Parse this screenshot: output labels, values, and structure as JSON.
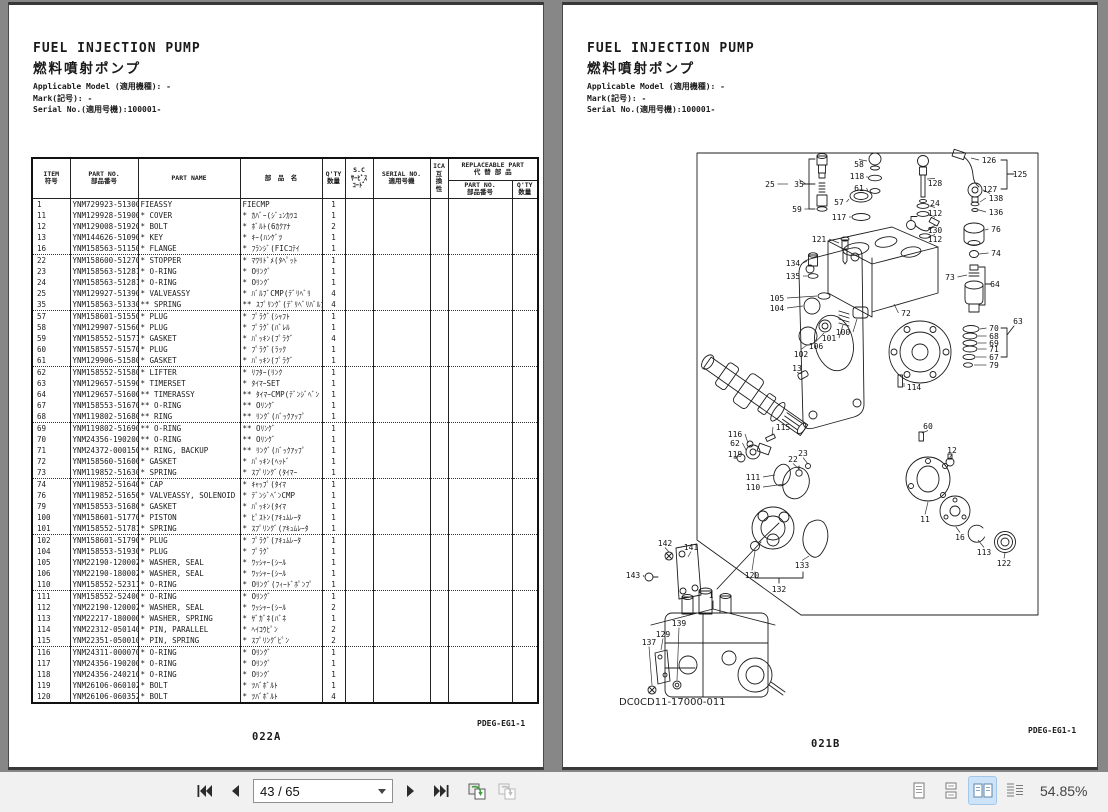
{
  "left_page": {
    "title_en": "FUEL INJECTION PUMP",
    "title_jp": "燃料噴射ポンプ",
    "meta_lines": [
      "Applicable Model (適用機種): -",
      "Mark(記号): -",
      "Serial No.(適用号機):100001-"
    ],
    "table": {
      "headers": {
        "item": "ITEM\n符号",
        "part_no": "PART NO.\n部品番号",
        "part_name": "PART NAME",
        "part_name_jp": "部　品　名",
        "qty": "Q'TY\n数量",
        "sc": "S.C\nｻｰﾋﾞｽ\nｺｰﾄﾞ",
        "serial_no": "SERIAL NO.\n適用号機",
        "ica": "ICA\n互\n換\n性",
        "replaceable": "REPLACEABLE PART\n代 替 部 品",
        "r_part_no": "PART NO.\n部品番号",
        "r_qty": "Q'TY\n数量"
      },
      "rows": [
        [
          "1",
          "YNM729923-51300",
          "FIEASSY",
          "FIECMP",
          "1"
        ],
        [
          "11",
          "YNM129928-51900",
          "* COVER",
          "* ｶﾊﾞｰ(ｼﾞｭﾝｶﾂﾕ",
          "1"
        ],
        [
          "12",
          "YNM129008-51920",
          "* BOLT",
          "* ﾎﾞﾙﾄ(6ｶｸｱﾅ",
          "2"
        ],
        [
          "13",
          "YNM144626-51090",
          "* KEY",
          "* ｷｰ(ﾊﾝｹﾞﾂ",
          "1"
        ],
        [
          "16",
          "YNM158563-51150",
          "* FLANGE",
          "* ﾌﾗﾝｼﾞ(FICｺﾃｲ",
          "1"
        ],
        [
          "22",
          "YNM158600-51270",
          "* STOPPER",
          "* ﾏﾜﾘﾄﾞﾒ(ﾀﾍﾟｯﾄ",
          "1"
        ],
        [
          "23",
          "YNM158563-51281",
          "* O-RING",
          "* Oﾘﾝｸﾞ",
          "1"
        ],
        [
          "24",
          "YNM158563-51281",
          "* O-RING",
          "* Oﾘﾝｸﾞ",
          "1"
        ],
        [
          "25",
          "YNM129927-51390",
          "* VALVEASSY",
          "* ﾊﾞﾙﾌﾞCMP(ﾃﾞﾘﾍﾞﾘ",
          "4"
        ],
        [
          "35",
          "YNM158563-51330",
          "** SPRING",
          "** ｽﾌﾟﾘﾝｸﾞ(ﾃﾞﾘﾍﾞﾘﾊﾞﾙﾌﾞ",
          "4"
        ],
        [
          "57",
          "YNM158601-51550",
          "* PLUG",
          "* ﾌﾟﾗｸﾞ(ｼｬﾌﾄ",
          "1"
        ],
        [
          "58",
          "YNM129907-51560",
          "* PLUG",
          "* ﾌﾟﾗｸﾞ(ﾊﾞﾚﾙ",
          "1"
        ],
        [
          "59",
          "YNM158552-51571",
          "* GASKET",
          "* ﾊﾟｯｷﾝ(ﾌﾟﾗｸﾞ",
          "4"
        ],
        [
          "60",
          "YNM158557-51570",
          "* PLUG",
          "* ﾌﾟﾗｸﾞ(ﾗｯｸ",
          "1"
        ],
        [
          "61",
          "YNM129906-51580",
          "* GASKET",
          "* ﾊﾟｯｷﾝ(ﾌﾟﾗｸﾞ",
          "1"
        ],
        [
          "62",
          "YNM158552-51580",
          "* LIFTER",
          "* ﾘﾌﾀｰ(ﾘﾝｸ",
          "1"
        ],
        [
          "63",
          "YNM129657-51590",
          "* TIMERSET",
          "* ﾀｲﾏｰSET",
          "1"
        ],
        [
          "64",
          "YNM129657-51600",
          "** TIMERASSY",
          "** ﾀｲﾏｰCMP(ﾃﾞﾝｼﾞﾍﾞﾝ",
          "1"
        ],
        [
          "67",
          "YNM158553-51670",
          "** O-RING",
          "** Oﾘﾝｸﾞ",
          "1"
        ],
        [
          "68",
          "YNM119802-51680",
          "** RING",
          "** ﾘﾝｸﾞ(ﾊﾞｯｸｱｯﾌﾟ",
          "1"
        ],
        [
          "69",
          "YNM119802-51690",
          "** O-RING",
          "** Oﾘﾝｸﾞ",
          "1"
        ],
        [
          "70",
          "YNM24356-190200",
          "** O-RING",
          "** Oﾘﾝｸﾞ",
          "1"
        ],
        [
          "71",
          "YNM24372-000150",
          "** RING, BACKUP",
          "** ﾘﾝｸﾞ(ﾊﾞｯｸｱｯﾌﾟ",
          "1"
        ],
        [
          "72",
          "YNM158560-51600",
          "* GASKET",
          "* ﾊﾟｯｷﾝ(ﾍｯﾄﾞ",
          "1"
        ],
        [
          "73",
          "YNM119852-51630",
          "* SPRING",
          "* ｽﾌﾟﾘﾝｸﾞ(ﾀｲﾏｰ",
          "1"
        ],
        [
          "74",
          "YNM119852-51640",
          "* CAP",
          "* ｷｬｯﾌﾟ(ﾀｲﾏ",
          "1"
        ],
        [
          "76",
          "YNM119852-51650",
          "* VALVEASSY, SOLENOID",
          "* ﾃﾞﾝｼﾞﾍﾞﾝCMP",
          "1"
        ],
        [
          "79",
          "YNM158553-51680",
          "* GASKET",
          "* ﾊﾟｯｷﾝ(ﾀｲﾏ",
          "1"
        ],
        [
          "100",
          "YNM158601-51770",
          "* PISTON",
          "* ﾋﾟｽﾄﾝ(ｱｷｭﾑﾚｰﾀ",
          "1"
        ],
        [
          "101",
          "YNM158552-51781",
          "* SPRING",
          "* ｽﾌﾟﾘﾝｸﾞ(ｱｷｭﾑﾚｰﾀ",
          "1"
        ],
        [
          "102",
          "YNM158601-51790",
          "* PLUG",
          "* ﾌﾟﾗｸﾞ(ｱｷｭﾑﾚｰﾀ",
          "1"
        ],
        [
          "104",
          "YNM158553-51930",
          "* PLUG",
          "* ﾌﾟﾗｸﾞ",
          "1"
        ],
        [
          "105",
          "YNM22190-120002",
          "* WASHER, SEAL",
          "* ﾜｯｼｬｰ(ｼｰﾙ",
          "1"
        ],
        [
          "106",
          "YNM22190-180002",
          "* WASHER, SEAL",
          "* ﾜｯｼｬｰ(ｼｰﾙ",
          "1"
        ],
        [
          "110",
          "YNM158552-52311",
          "* O-RING",
          "* Oﾘﾝｸﾞ(ﾌｨｰﾄﾞﾎﾟﾝﾌﾟ",
          "1"
        ],
        [
          "111",
          "YNM158552-52400",
          "* O-RING",
          "* Oﾘﾝｸﾞ",
          "1"
        ],
        [
          "112",
          "YNM22190-120002",
          "* WASHER, SEAL",
          "* ﾜｯｼｬｰ(ｼｰﾙ",
          "2"
        ],
        [
          "113",
          "YNM22217-180000",
          "* WASHER, SPRING",
          "* ｻﾞｶﾞﾈ(ﾊﾞﾈ",
          "1"
        ],
        [
          "114",
          "YNM22312-050140",
          "* PIN, PARALLEL",
          "* ﾍｲｺｳﾋﾟﾝ",
          "2"
        ],
        [
          "115",
          "YNM22351-050010",
          "* PIN, SPRING",
          "* ｽﾌﾟﾘﾝｸﾞﾋﾟﾝ",
          "2"
        ],
        [
          "116",
          "YNM24311-000070",
          "* O-RING",
          "* Oﾘﾝｸﾞ",
          "1"
        ],
        [
          "117",
          "YNM24356-190200",
          "* O-RING",
          "* Oﾘﾝｸﾞ",
          "1"
        ],
        [
          "118",
          "YNM24356-240210",
          "* O-RING",
          "* Oﾘﾝｸﾞ",
          "1"
        ],
        [
          "119",
          "YNM26106-060102",
          "* BOLT",
          "* ﾂﾊﾞﾎﾞﾙﾄ",
          "1"
        ],
        [
          "120",
          "YNM26106-060352",
          "* BOLT",
          "* ﾂﾊﾞﾎﾞﾙﾄ",
          "4"
        ]
      ],
      "group_breaks_after": [
        "16",
        "35",
        "61",
        "68",
        "73",
        "101",
        "110",
        "115"
      ]
    },
    "doc_code": "PDEG-EG1-1",
    "page_code": "022A"
  },
  "right_page": {
    "title_en": "FUEL INJECTION PUMP",
    "title_jp": "燃料噴射ポンプ",
    "meta_lines": [
      "Applicable Model (適用機種): -",
      "Mark(記号): -",
      "Serial No.(適用号機):100001-"
    ],
    "figure": {
      "drawing_no": "DC0CD11-17000-011",
      "callouts": [
        {
          "n": "25",
          "x": 167,
          "y": 39,
          "lx": 185,
          "ly": 39
        },
        {
          "n": "35",
          "x": 196,
          "y": 39,
          "lx": 203,
          "ly": 39
        },
        {
          "n": "58",
          "x": 256,
          "y": 19,
          "lx": 264,
          "ly": 16
        },
        {
          "n": "118",
          "x": 254,
          "y": 31,
          "lx": 264,
          "ly": 33
        },
        {
          "n": "61",
          "x": 256,
          "y": 43,
          "lx": 265,
          "ly": 46
        },
        {
          "n": "57",
          "x": 236,
          "y": 57,
          "lx": 246,
          "ly": 54
        },
        {
          "n": "117",
          "x": 236,
          "y": 72,
          "lx": 248,
          "ly": 72
        },
        {
          "n": "59",
          "x": 194,
          "y": 64,
          "lx": 212,
          "ly": 64
        },
        {
          "n": "128",
          "x": 332,
          "y": 38,
          "lx": 324,
          "ly": 34
        },
        {
          "n": "24",
          "x": 332,
          "y": 58,
          "lx": 327,
          "ly": 61
        },
        {
          "n": "112",
          "x": 332,
          "y": 68,
          "lx": 326,
          "ly": 69
        },
        {
          "n": "130",
          "x": 332,
          "y": 85,
          "lx": 325,
          "ly": 84
        },
        {
          "n": "112",
          "x": 332,
          "y": 94,
          "lx": 328,
          "ly": 91
        },
        {
          "n": "126",
          "x": 386,
          "y": 15,
          "lx": 368,
          "ly": 13
        },
        {
          "n": "125",
          "x": 417,
          "y": 29
        },
        {
          "n": "127",
          "x": 387,
          "y": 44,
          "lx": 380,
          "ly": 45
        },
        {
          "n": "138",
          "x": 393,
          "y": 53,
          "lx": 377,
          "ly": 57
        },
        {
          "n": "136",
          "x": 393,
          "y": 67,
          "lx": 376,
          "ly": 65
        },
        {
          "n": "76",
          "x": 393,
          "y": 84,
          "lx": 382,
          "ly": 85
        },
        {
          "n": "74",
          "x": 393,
          "y": 108,
          "lx": 376,
          "ly": 109
        },
        {
          "n": "73",
          "x": 347,
          "y": 132,
          "lx": 364,
          "ly": 130
        },
        {
          "n": "64",
          "x": 392,
          "y": 139
        },
        {
          "n": "63",
          "x": 415,
          "y": 176
        },
        {
          "n": "70",
          "x": 391,
          "y": 183,
          "lx": 377,
          "ly": 184
        },
        {
          "n": "68",
          "x": 391,
          "y": 191,
          "lx": 375,
          "ly": 191
        },
        {
          "n": "69",
          "x": 391,
          "y": 198,
          "lx": 375,
          "ly": 198
        },
        {
          "n": "71",
          "x": 391,
          "y": 204,
          "lx": 375,
          "ly": 204
        },
        {
          "n": "67",
          "x": 391,
          "y": 212,
          "lx": 373,
          "ly": 212
        },
        {
          "n": "79",
          "x": 391,
          "y": 220,
          "lx": 371,
          "ly": 220
        },
        {
          "n": "121",
          "x": 216,
          "y": 94,
          "lx": 236,
          "ly": 98
        },
        {
          "n": "134",
          "x": 190,
          "y": 118,
          "lx": 204,
          "ly": 116
        },
        {
          "n": "135",
          "x": 190,
          "y": 131,
          "lx": 204,
          "ly": 131
        },
        {
          "n": "105",
          "x": 174,
          "y": 153,
          "lx": 214,
          "ly": 151
        },
        {
          "n": "104",
          "x": 174,
          "y": 163,
          "lx": 200,
          "ly": 161
        },
        {
          "n": "72",
          "x": 303,
          "y": 168,
          "lx": 291,
          "ly": 159
        },
        {
          "n": "100",
          "x": 240,
          "y": 187,
          "lx": 254,
          "ly": 174
        },
        {
          "n": "101",
          "x": 226,
          "y": 193,
          "lx": 240,
          "ly": 180
        },
        {
          "n": "106",
          "x": 213,
          "y": 201,
          "lx": 221,
          "ly": 188
        },
        {
          "n": "102",
          "x": 198,
          "y": 209,
          "lx": 204,
          "ly": 200
        },
        {
          "n": "13",
          "x": 194,
          "y": 223,
          "lx": 199,
          "ly": 229
        },
        {
          "n": "114",
          "x": 311,
          "y": 242,
          "lx": 301,
          "ly": 238
        },
        {
          "n": "60",
          "x": 325,
          "y": 281,
          "lx": 319,
          "ly": 288
        },
        {
          "n": "12",
          "x": 349,
          "y": 305,
          "lx": 347,
          "ly": 312
        },
        {
          "n": "115",
          "x": 180,
          "y": 282,
          "lx": 169,
          "ly": 291
        },
        {
          "n": "116",
          "x": 132,
          "y": 289,
          "lx": 145,
          "ly": 298
        },
        {
          "n": "62",
          "x": 132,
          "y": 298,
          "lx": 143,
          "ly": 305
        },
        {
          "n": "119",
          "x": 132,
          "y": 309,
          "lx": 134,
          "ly": 312
        },
        {
          "n": "23",
          "x": 200,
          "y": 308,
          "lx": 205,
          "ly": 319
        },
        {
          "n": "22",
          "x": 190,
          "y": 314,
          "lx": 196,
          "ly": 324
        },
        {
          "n": "111",
          "x": 150,
          "y": 332,
          "lx": 172,
          "ly": 330
        },
        {
          "n": "110",
          "x": 150,
          "y": 342,
          "lx": 182,
          "ly": 339
        },
        {
          "n": "11",
          "x": 322,
          "y": 374,
          "lx": 325,
          "ly": 357
        },
        {
          "n": "16",
          "x": 357,
          "y": 392,
          "lx": 353,
          "ly": 382
        },
        {
          "n": "113",
          "x": 381,
          "y": 407,
          "lx": 375,
          "ly": 395
        },
        {
          "n": "122",
          "x": 401,
          "y": 418,
          "lx": 402,
          "ly": 408
        },
        {
          "n": "120",
          "x": 149,
          "y": 430,
          "lx": 152,
          "ly": 406
        },
        {
          "n": "133",
          "x": 199,
          "y": 420,
          "lx": 206,
          "ly": 411
        },
        {
          "n": "132",
          "x": 176,
          "y": 444
        },
        {
          "n": "1",
          "x": 108,
          "y": 450
        },
        {
          "n": "142",
          "x": 62,
          "y": 398,
          "lx": 66,
          "ly": 407
        },
        {
          "n": "141",
          "x": 88,
          "y": 402,
          "lx": 85,
          "ly": 412
        },
        {
          "n": "143",
          "x": 30,
          "y": 430,
          "lx": 41,
          "ly": 432
        },
        {
          "n": "139",
          "x": 76,
          "y": 478,
          "lx": 74,
          "ly": 535
        },
        {
          "n": "129",
          "x": 60,
          "y": 489,
          "lx": 58,
          "ly": 505
        },
        {
          "n": "137",
          "x": 46,
          "y": 497,
          "lx": 49,
          "ly": 540
        }
      ]
    },
    "doc_code": "PDEG-EG1-1",
    "page_code": "021B"
  },
  "toolbar": {
    "page_display": "43 / 65",
    "zoom_level": "54.85%",
    "view_modes": [
      "single-page",
      "continuous",
      "facing",
      "facing-continuous"
    ],
    "active_view_mode": "facing",
    "icons": {
      "first_page": "|◀◀",
      "previous_page": "◀",
      "next_page": "▶",
      "last_page": "▶▶|",
      "page_selector_caret": "▼",
      "insert_page": "overlapping-pages-green-arrow",
      "extract_page": "overlapping-pages-gray"
    }
  }
}
